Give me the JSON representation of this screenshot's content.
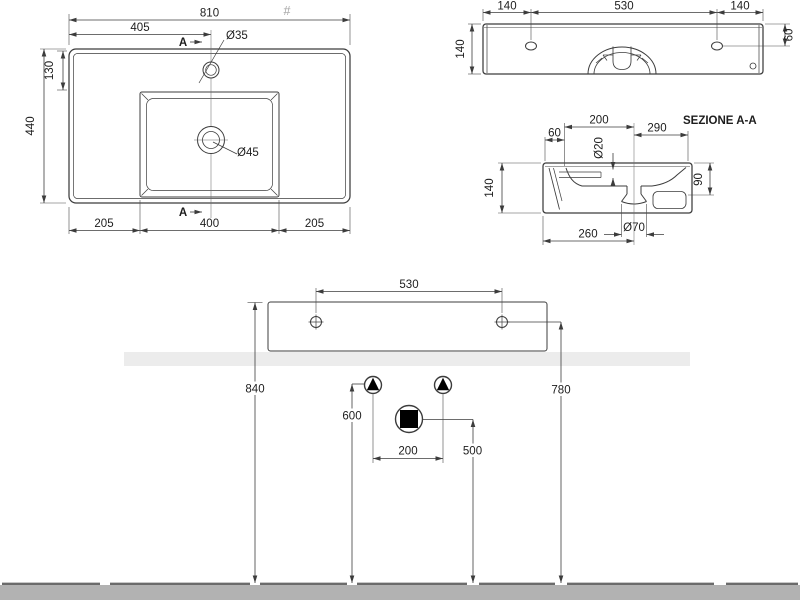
{
  "meta": {
    "hash_mark": "#"
  },
  "colors": {
    "line": "#3c3c3c",
    "counter_band": "#ececec",
    "floor": "#b2b2b2",
    "floor_edge": "#6b6b6b",
    "symbol_fill": "#000000"
  },
  "plan_view": {
    "overall_width": "810",
    "tap_center_offset": "405",
    "tap_hole_dia": "Ø35",
    "tap_hole_from_edge": "130",
    "overall_depth": "440",
    "bowl_left_offset": "205",
    "bowl_width": "400",
    "bowl_right_offset": "205",
    "drain_dia": "Ø45",
    "section_marker": "A"
  },
  "rear_view": {
    "left_hole_inset": "140",
    "hole_spacing": "530",
    "right_hole_inset": "140",
    "height": "140",
    "hole_from_top": "60"
  },
  "section_view": {
    "title": "SEZIONE A-A",
    "back_ledge_width": "60",
    "ledge_to_drain": "200",
    "drain_to_front": "290",
    "overflow_dia": "Ø20",
    "height": "140",
    "inner_depth": "90",
    "back_to_drain": "260",
    "outlet_dia": "Ø70"
  },
  "installation_view": {
    "hole_spacing": "530",
    "rim_height": "840",
    "hole_height": "780",
    "supply_height": "600",
    "supply_spacing": "200",
    "waste_height": "500"
  }
}
